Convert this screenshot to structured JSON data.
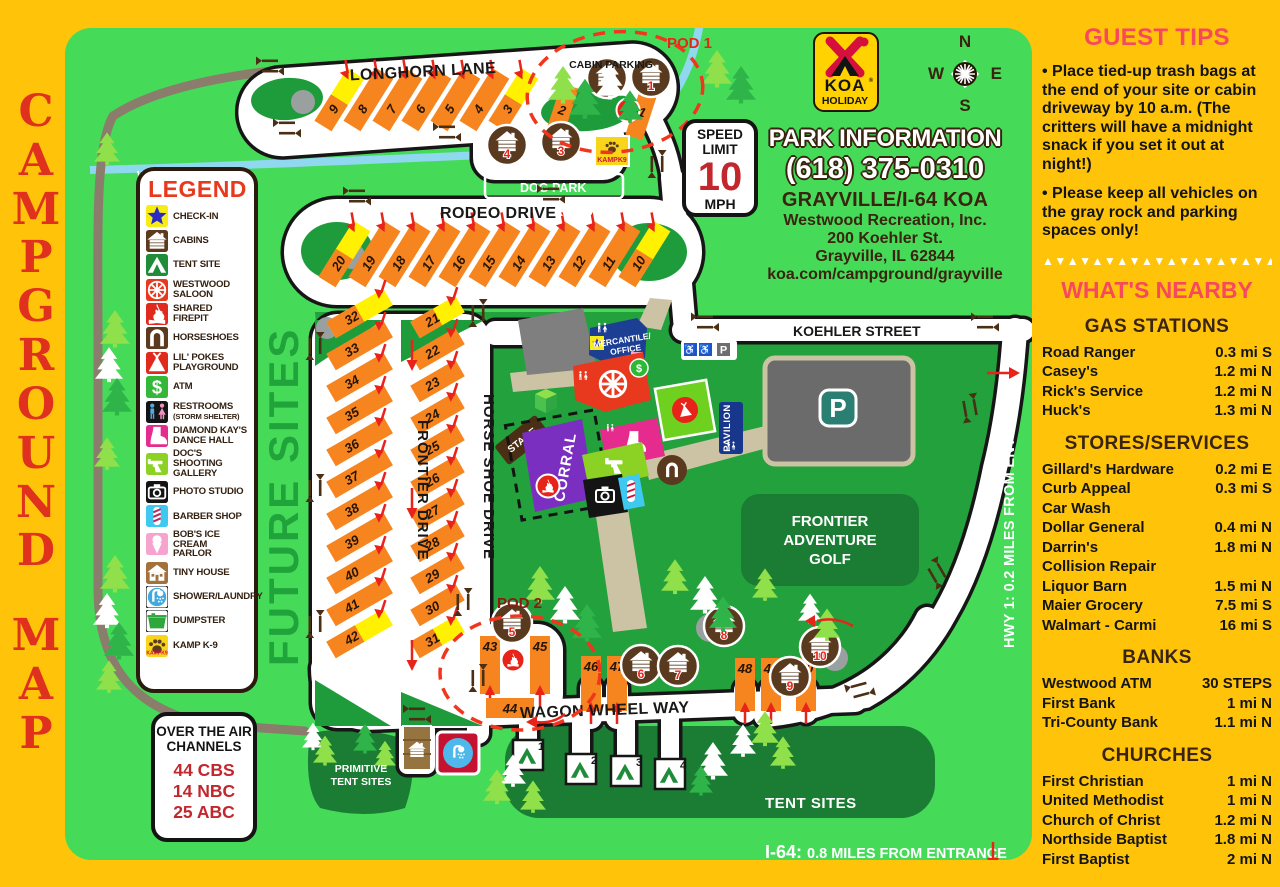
{
  "page_title": {
    "word1": "CAMPGROUND",
    "word2": "MAP"
  },
  "koa_logo": {
    "brand": "KOA",
    "tier": "HOLIDAY"
  },
  "compass": {
    "n": "N",
    "e": "E",
    "s": "S",
    "w": "W"
  },
  "speed_sign": {
    "line1": "SPEED",
    "line2": "LIMIT",
    "value": "10",
    "unit": "MPH"
  },
  "park_info": {
    "title": "PARK INFORMATION",
    "phone": "(618) 375-0310",
    "campground": "GRAYVILLE/I-64 KOA",
    "org": "Westwood Recreation, Inc.",
    "street": "200 Koehler St.",
    "city": "Grayville, IL 62844",
    "web": "koa.com/campground/grayville"
  },
  "over_the_air": {
    "title_line1": "OVER THE AIR",
    "title_line2": "CHANNELS",
    "channels": [
      "44 CBS",
      "14 NBC",
      "25 ABC"
    ]
  },
  "guest_tips": {
    "title": "GUEST TIPS",
    "tips": [
      "Place tied-up trash bags at the end of your site or cabin driveway by 10 a.m. (The critters will have a midnight snack if you set it out at night!)",
      "Please keep all vehicles on the gray rock and parking spaces only!"
    ]
  },
  "whats_nearby": {
    "title": "WHAT'S NEARBY",
    "sections": [
      {
        "title": "GAS STATIONS",
        "rows": [
          {
            "name": "Road Ranger",
            "dist": "0.3 mi S"
          },
          {
            "name": "Casey's",
            "dist": "1.2 mi N"
          },
          {
            "name": "Rick's Service",
            "dist": "1.2 mi N"
          },
          {
            "name": "Huck's",
            "dist": "1.3 mi N"
          }
        ]
      },
      {
        "title": "STORES/SERVICES",
        "rows": [
          {
            "name": "Gillard's Hardware",
            "dist": "0.2 mi E"
          },
          {
            "name": "Curb Appeal",
            "name2": "Car Wash",
            "dist": "0.3 mi S"
          },
          {
            "name": "Dollar General",
            "dist": "0.4 mi N"
          },
          {
            "name": "Darrin's",
            "name2": "Collision Repair",
            "dist": "1.8 mi N"
          },
          {
            "name": "Liquor Barn",
            "dist": "1.5 mi N"
          },
          {
            "name": "Maier Grocery",
            "dist": "7.5 mi S"
          },
          {
            "name": "Walmart - Carmi",
            "dist": "16 mi S"
          }
        ]
      },
      {
        "title": "BANKS",
        "rows": [
          {
            "name": "Westwood ATM",
            "dist": "30 STEPS"
          },
          {
            "name": "First Bank",
            "dist": "1 mi N"
          },
          {
            "name": "Tri-County Bank",
            "dist": "1.1 mi N"
          }
        ]
      },
      {
        "title": "CHURCHES",
        "rows": [
          {
            "name": "First Christian",
            "dist": "1 mi N"
          },
          {
            "name": "United Methodist",
            "dist": "1 mi N"
          },
          {
            "name": "Church of Christ",
            "dist": "1.2 mi N"
          },
          {
            "name": "Northside Baptist",
            "dist": "1.8 mi N"
          },
          {
            "name": "First Baptist",
            "dist": "2 mi N"
          }
        ]
      }
    ]
  },
  "legend": {
    "title": "LEGEND",
    "items": [
      {
        "icon": "star",
        "bg": "#F8EC16",
        "fg": "#2B2BC4",
        "label": [
          "CHECK-IN"
        ]
      },
      {
        "icon": "cabin",
        "bg": "#5C3A1E",
        "fg": "#FFFFFF",
        "label": [
          "CABINS"
        ]
      },
      {
        "icon": "tent",
        "bg": "#1E8C38",
        "fg": "#FFFFFF",
        "label": [
          "TENT SITE"
        ]
      },
      {
        "icon": "wheel",
        "bg": "#E8391E",
        "fg": "#FFFFFF",
        "label": [
          "WESTWOOD",
          "SALOON"
        ]
      },
      {
        "icon": "fire",
        "bg": "#E02A1E",
        "fg": "#FFFFFF",
        "label": [
          "SHARED FIREPIT"
        ]
      },
      {
        "icon": "horseshoe",
        "bg": "#5C3A1E",
        "fg": "#FFFFFF",
        "label": [
          "HORSESHOES"
        ]
      },
      {
        "icon": "teepee",
        "bg": "#E02A1E",
        "fg": "#FFFFFF",
        "label": [
          "LIL' POKES",
          "PLAYGROUND"
        ]
      },
      {
        "icon": "dollar",
        "bg": "#35B838",
        "fg": "#FFFFFF",
        "label": [
          "ATM"
        ]
      },
      {
        "icon": "wc",
        "bg": "#141414",
        "fg": "#FFFFFF",
        "label": [
          "RESTROOMS"
        ],
        "sub": "(STORM SHELTER)"
      },
      {
        "icon": "boot",
        "bg": "#E62B8E",
        "fg": "#FFFFFF",
        "label": [
          "DIAMOND KAY'S",
          "DANCE HALL"
        ]
      },
      {
        "icon": "gun",
        "bg": "#8CD225",
        "fg": "#FFFFFF",
        "label": [
          "DOC'S SHOOTING",
          "GALLERY"
        ]
      },
      {
        "icon": "camera",
        "bg": "#141414",
        "fg": "#FFFFFF",
        "label": [
          "PHOTO STUDIO"
        ]
      },
      {
        "icon": "pole",
        "bg": "#3FC8F0",
        "fg": "#FFFFFF",
        "label": [
          "BARBER SHOP"
        ]
      },
      {
        "icon": "cone",
        "bg": "#F7A3CF",
        "fg": "#FFFFFF",
        "label": [
          "BOB'S ICE CREAM",
          "PARLOR"
        ]
      },
      {
        "icon": "house",
        "bg": "#A3713C",
        "fg": "#FFFFFF",
        "label": [
          "TINY HOUSE"
        ]
      },
      {
        "icon": "shower",
        "bg": "#FFFFFF",
        "fg": "#3FA9E0",
        "label": [
          "SHOWER/LAUNDRY"
        ]
      },
      {
        "icon": "dump",
        "bg": "#FFFFFF",
        "fg": "#2EA83C",
        "label": [
          "DUMPSTER"
        ]
      },
      {
        "icon": "paw",
        "bg": "#F8D51B",
        "fg": "#5C3A1E",
        "label": [
          "KAMP K-9"
        ],
        "badge": "KAMPK9"
      }
    ]
  },
  "map": {
    "road_labels": {
      "longhorn": "LONGHORN LANE",
      "rodeo": "RODEO DRIVE",
      "koehler": "KOEHLER STREET",
      "wagon_wheel": "WAGON WHEEL WAY",
      "frontier": "FRONTIER DRIVE",
      "horse_shoe": "HORSE SHOE DRIVE"
    },
    "area_labels": {
      "walking_trail": "WALKING TRAIL",
      "future_sites": "FUTURE SITES",
      "cabin_parking": "CABIN PARKING",
      "pod1": "POD 1",
      "pod2": "POD 2",
      "dog_park": "DOG PARK",
      "firewood": "FIREWOOD",
      "primitive_line1": "PRIMITIVE",
      "primitive_line2": "TENT SITES",
      "tent_sites": "TENT SITES",
      "golf_line1": "FRONTIER",
      "golf_line2": "ADVENTURE",
      "golf_line3": "GOLF",
      "hwy": "HWY 1: 0.2 MILES FROM ENTRANCE",
      "i64_prefix": "I-64:",
      "i64_rest": "0.8 MILES FROM ENTRANCE",
      "parking": "P",
      "mercantile_line1": "MERCANTILE/",
      "mercantile_line2": "OFFICE",
      "pavilion": "PAVILION",
      "corral": "CORRAL",
      "stage": "STAGE"
    },
    "sites": {
      "longhorn": [
        "9",
        "8",
        "7",
        "6",
        "5",
        "4",
        "3"
      ],
      "pod1_bars": [
        "2",
        "1"
      ],
      "rodeo": [
        "20",
        "19",
        "18",
        "17",
        "16",
        "15",
        "14",
        "13",
        "12",
        "11",
        "10"
      ],
      "frontier_col": [
        "32",
        "33",
        "34",
        "35",
        "36",
        "37",
        "38",
        "39",
        "40",
        "41",
        "42"
      ],
      "horse_shoe_col": [
        "21",
        "22",
        "23",
        "24",
        "25",
        "26",
        "27",
        "28",
        "29",
        "30",
        "31"
      ],
      "pod2_bars": [
        "43",
        "45"
      ],
      "pod2_pull": "44",
      "wagon_bars_west": [
        "46",
        "47"
      ],
      "wagon_bars_east": [
        "48",
        "49",
        "50"
      ],
      "tent_squares": [
        "1",
        "2",
        "3",
        "4"
      ]
    },
    "cabins": {
      "pod1": [
        "2",
        "1"
      ],
      "north_row": [
        "4",
        "3"
      ],
      "pod2": [
        "5"
      ],
      "south": [
        "6",
        "7"
      ],
      "east": [
        "8",
        "9",
        "10"
      ]
    }
  }
}
